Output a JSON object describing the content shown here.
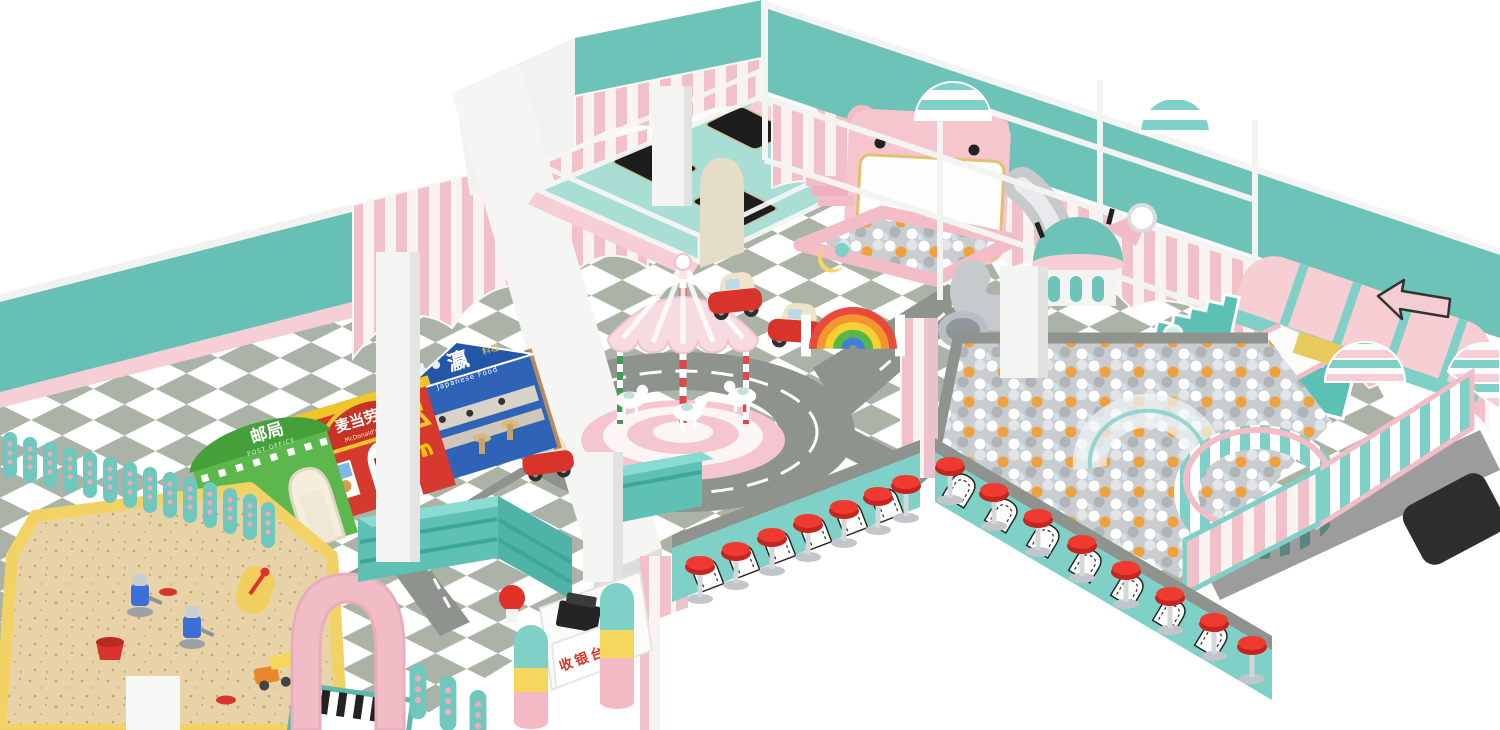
{
  "signs": {
    "post_office_cn": "邮局",
    "post_office_en": "POST OFFICE",
    "mcdonalds_cn": "麦当劳",
    "mcdonalds_en": "McDonald's",
    "japanese_restaurant_cn": "瀛",
    "japanese_restaurant_cn_suffix": "料理",
    "japanese_restaurant_en": "Japanese Food",
    "cashier_cn": "收银台"
  },
  "palette": {
    "teal_wall": "#6ec3b9",
    "teal_equipment": "#7fd0c6",
    "pink_wall": "#f6ced6",
    "pink_stripe": "#f2c0c9",
    "mint_trampoline": "#a8ded4",
    "floor_tile_green": "#a9b2a6",
    "floor_tile_white": "#ffffff",
    "road_gray": "#8e948d",
    "accent_red": "#e8302a",
    "mcdonalds_red": "#d63a2e",
    "mcdonalds_yellow": "#f7c600",
    "post_office_green": "#5cb84d",
    "japanese_blue": "#2f63b8",
    "sand": "#e8d3a8",
    "ball_orange": "#f0a13b",
    "ball_gray": "#aeb4b8"
  }
}
